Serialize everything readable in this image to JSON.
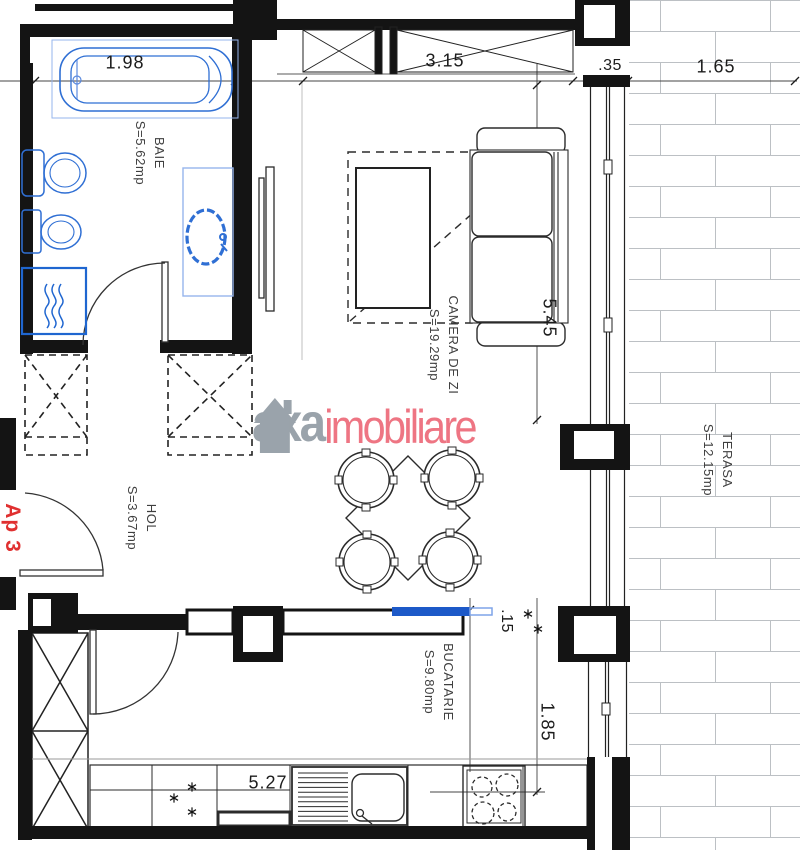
{
  "plan": {
    "apartment_label": "Ap 3",
    "watermark": {
      "brand": "axa",
      "brand_suffix": "imobiliare"
    },
    "rooms": {
      "baie": {
        "name": "BAIE",
        "area": "S=5.62mp"
      },
      "camera": {
        "name": "CAMERA DE ZI",
        "area": "S=19.29mp"
      },
      "hol": {
        "name": "HOL",
        "area": "S=3.67mp"
      },
      "bucatarie": {
        "name": "BUCATARIE",
        "area": "S=9.80mp"
      },
      "terasa": {
        "name": "TERASA",
        "area": "S=12.15mp"
      }
    },
    "dimensions": {
      "bathtub_length": "1.98",
      "living_window_width": "3.15",
      "pillar_width": ".35",
      "terrace_width": "1.65",
      "living_room_length": "5.45",
      "wall_offset": ".15",
      "kitchen_window_height": "1.85",
      "kitchen_width": "5.27"
    },
    "icons": {
      "house_logo": "house-silhouette",
      "star_mark": "six-ray-star"
    },
    "colors": {
      "fixtures_blue": "#2f6fd4",
      "accent_blue": "#1d59c8",
      "brand_gray": "#9aa3ab",
      "brand_red": "#ee7583",
      "apartment_red": "#e03030",
      "brick_line": "#bcc0c4",
      "wall_black": "#141414"
    }
  }
}
